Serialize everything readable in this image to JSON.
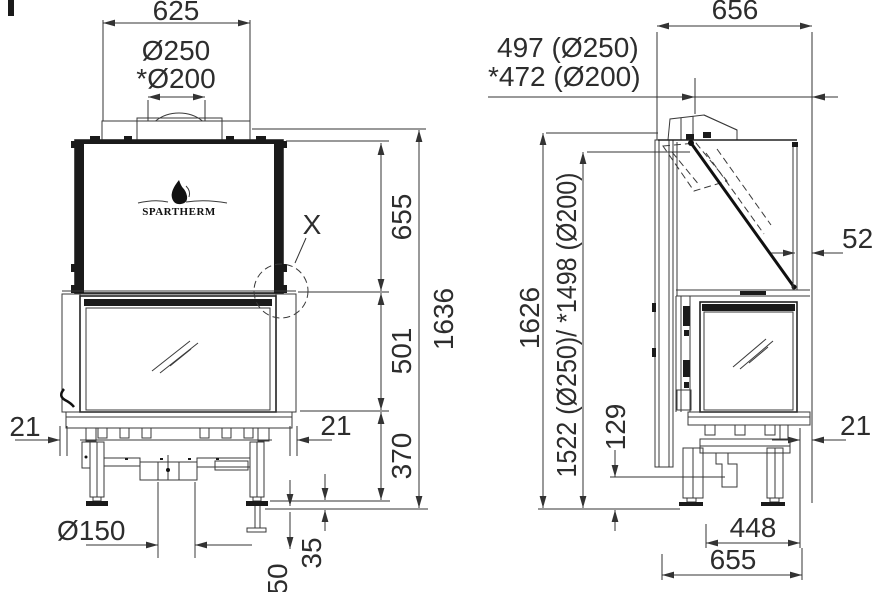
{
  "brand": {
    "logo_text": "SPARTHERM"
  },
  "front_view": {
    "width_top": "625",
    "flue_outer_dia": "Ø250",
    "flue_inner_dia": "*Ø200",
    "detail_marker": "X",
    "hood_height": "655",
    "door_height": "501",
    "base_height": "370",
    "total_height": "1636",
    "offset_left": "21",
    "offset_right": "21",
    "intake_dia": "Ø150",
    "foot_adjust": "35",
    "floor_clearance": "50"
  },
  "side_view": {
    "depth_top": "656",
    "flue_center_250": "497 (Ø250)",
    "flue_center_200": "*472 (Ø200)",
    "front_gap": "52",
    "total_height": "1626",
    "flue_height": "1522 (Ø250)/ *1498 (Ø200)",
    "base_clearance": "129",
    "offset_front": "21",
    "leg_spacing": "448",
    "depth_base": "655"
  }
}
